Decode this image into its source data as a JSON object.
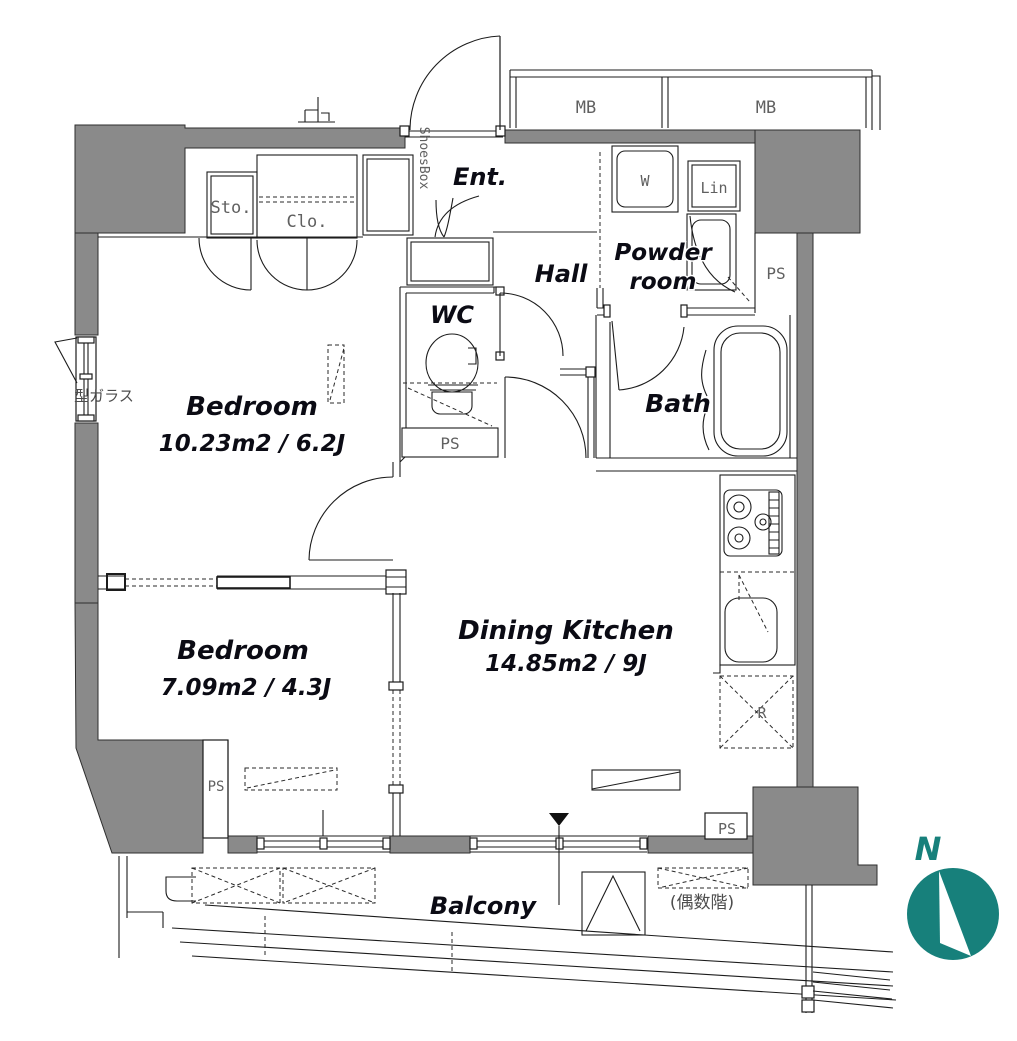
{
  "floorplan": {
    "rooms": {
      "bedroom_main": {
        "name": "Bedroom",
        "area": "10.23m2 / 6.2J"
      },
      "bedroom_second": {
        "name": "Bedroom",
        "area": "7.09m2 / 4.3J"
      },
      "dining_kitchen": {
        "name": "Dining Kitchen",
        "area": "14.85m2 / 9J"
      },
      "entrance": {
        "name": "Ent."
      },
      "hall": {
        "name": "Hall"
      },
      "wc": {
        "name": "WC"
      },
      "bath": {
        "name": "Bath"
      },
      "powder_room": {
        "name_line1": "Powder",
        "name_line2": "room"
      },
      "balcony": {
        "name": "Balcony"
      }
    },
    "labels": {
      "storage": "Sto.",
      "closet": "Clo.",
      "shoes_box": "ShoesBox",
      "meter_box_1": "MB",
      "meter_box_2": "MB",
      "washer": "W",
      "linen": "Lin",
      "refrigerator": "R",
      "pipe_space_wc": "PS",
      "pipe_space_powder": "PS",
      "pipe_space_bedroom": "PS",
      "pipe_space_kitchen": "PS",
      "frosted_glass": "型ガラス",
      "even_floor_note": "(偶数階)",
      "north_mark": "N"
    },
    "colors": {
      "wall_fill": "#8a8a8a",
      "compass_teal": "#17807b",
      "line": "#1c1c1c"
    }
  }
}
